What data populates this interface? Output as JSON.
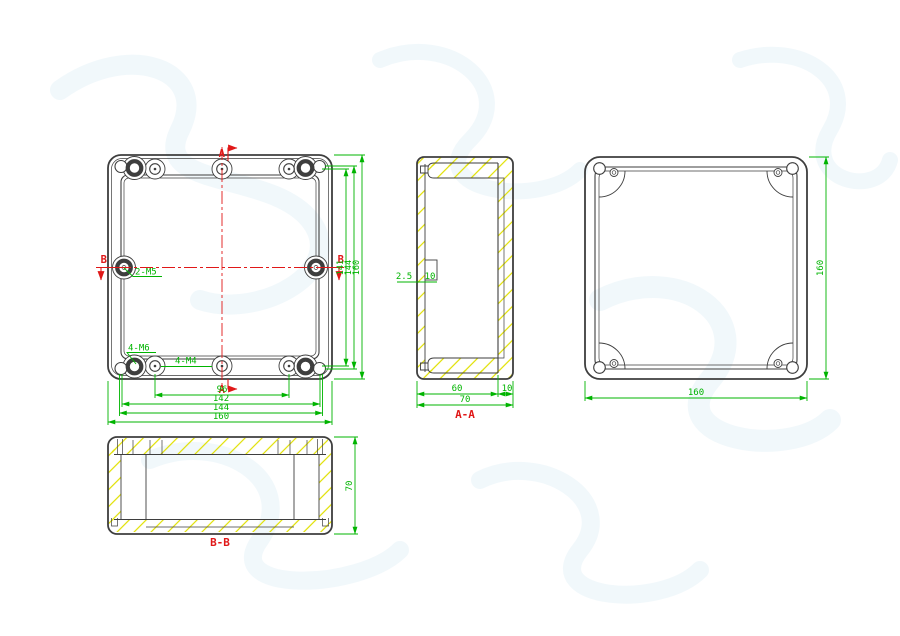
{
  "title": "Enclosure engineering drawing",
  "colors": {
    "line": "#3e3e3e",
    "dim": "#00b400",
    "center": "#e01818",
    "hatch": "#e0e000",
    "watermark": "#ecf5fa"
  },
  "views": {
    "front": {
      "name": "front view",
      "section_a": "A",
      "section_b": "B",
      "hole_labels": {
        "m5": "2-M5",
        "m6": "4-M6",
        "m4": "4-M4"
      },
      "dims": {
        "bottom": [
          "96",
          "142",
          "144",
          "160"
        ],
        "right": [
          "141",
          "144",
          "160"
        ]
      }
    },
    "aa": {
      "title": "A-A",
      "dims": {
        "inner_width": "60",
        "lid_thickness": "10",
        "total_width": "70",
        "wall": "2.5",
        "boss": "10"
      }
    },
    "cover": {
      "name": "cover view",
      "dims": {
        "width": "160",
        "height": "160"
      }
    },
    "bb": {
      "title": "B-B",
      "dims": {
        "height": "70"
      }
    }
  }
}
